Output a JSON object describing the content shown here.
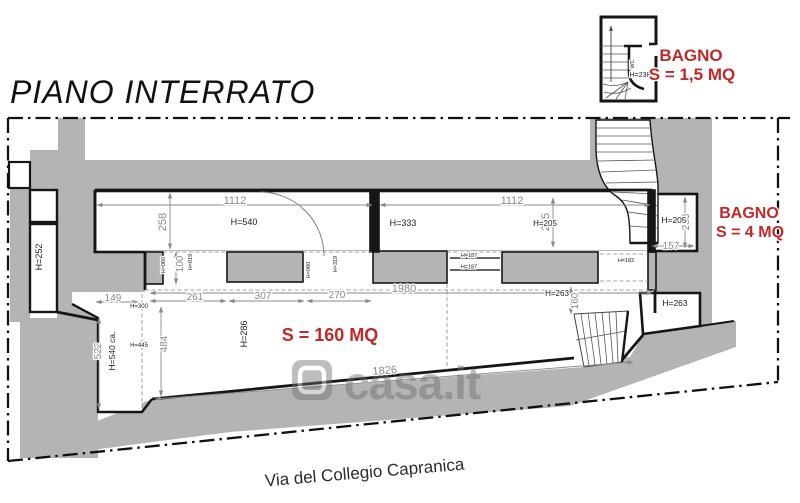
{
  "title": "PIANO INTERRATO",
  "street_label": "Via del Collegio Capranica",
  "watermark": "casa.it",
  "colors": {
    "accent_red": "#c42727",
    "wall_gray": "#b4b4b4",
    "dim_gray": "#8a8a8a"
  },
  "mini_plan": {
    "wc": "WC",
    "height": "H=238",
    "room": "BAGNO",
    "area": "S = 1,5 MQ"
  },
  "right_bath": {
    "room": "BAGNO",
    "area": "S = 4 MQ"
  },
  "main_room": {
    "area": "S = 160 MQ"
  },
  "dims": {
    "top_left_width": "1112",
    "top_right_width": "1112",
    "left_depth": "258",
    "right_depth": "245",
    "niche_depth": "100",
    "sub_width_1": "261",
    "sub_width_2": "307",
    "sub_width_3": "270",
    "hall_total_width": "1980",
    "hall_bottom_width": "1826",
    "hall_depth": "484",
    "corridor_width": "149",
    "corridor_length": "522",
    "small_room_depth": "253",
    "small_room_width": "157",
    "stair_depth": "160"
  },
  "heights": {
    "h540": "H=540",
    "h333": "H=333",
    "h205_center": "H=205",
    "h205_right": "H=205",
    "h252": "H=252",
    "h540ca": "H=540 ca.",
    "h300": "H=300",
    "h445": "H=445",
    "h286": "H=286",
    "h263_left": "H=263",
    "h263_right": "H=263",
    "h182": "H=182",
    "h187_a": "H=187",
    "h187_b": "H=187",
    "h060_a": "H=060",
    "h019": "H=019",
    "h060_b": "H=060",
    "h319": "H=319"
  }
}
